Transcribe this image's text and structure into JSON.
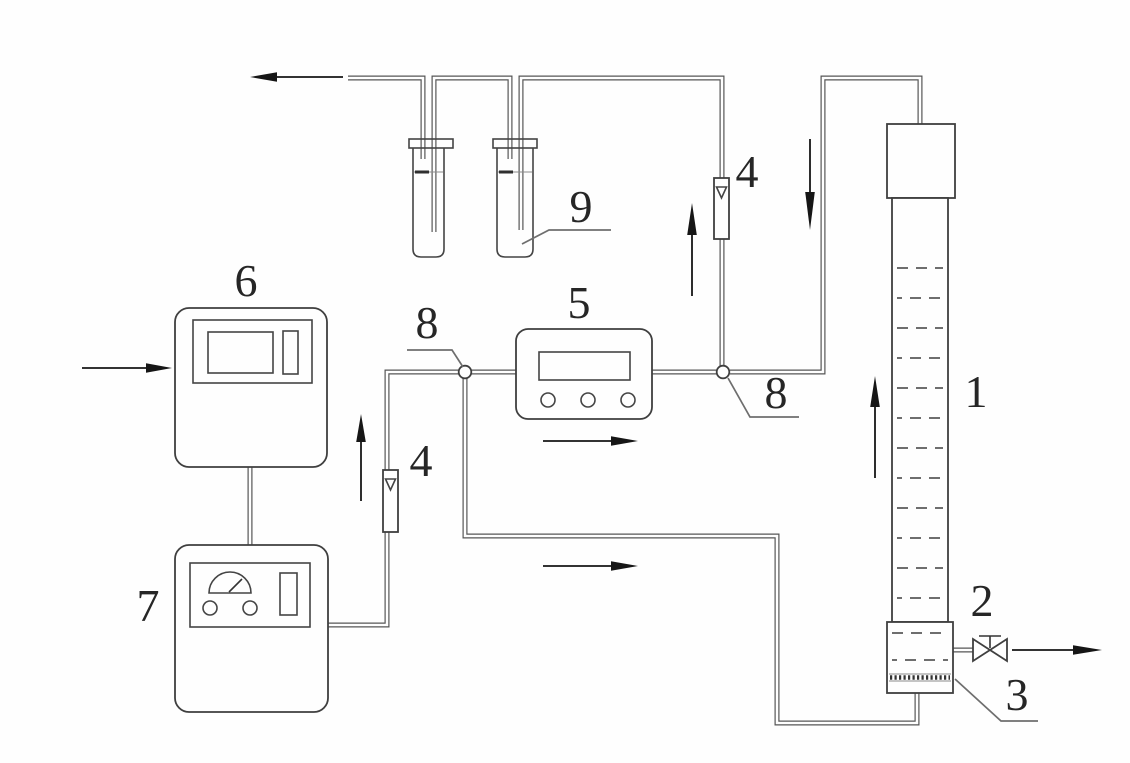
{
  "figure": {
    "kind": "experimental-apparatus-flow-diagram",
    "background": "#fefefe",
    "line_color": "#565656",
    "arrow_color": "#161616",
    "callouts": {
      "column": "1",
      "drain_valve": "2",
      "distributor_plate": "3",
      "flowmeter_right": "4",
      "flowmeter_left": "4",
      "analyzer": "5",
      "instrument_upper": "6",
      "instrument_lower": "7",
      "junction_left": "8",
      "junction_right": "8",
      "washing_bottles": "9"
    }
  }
}
